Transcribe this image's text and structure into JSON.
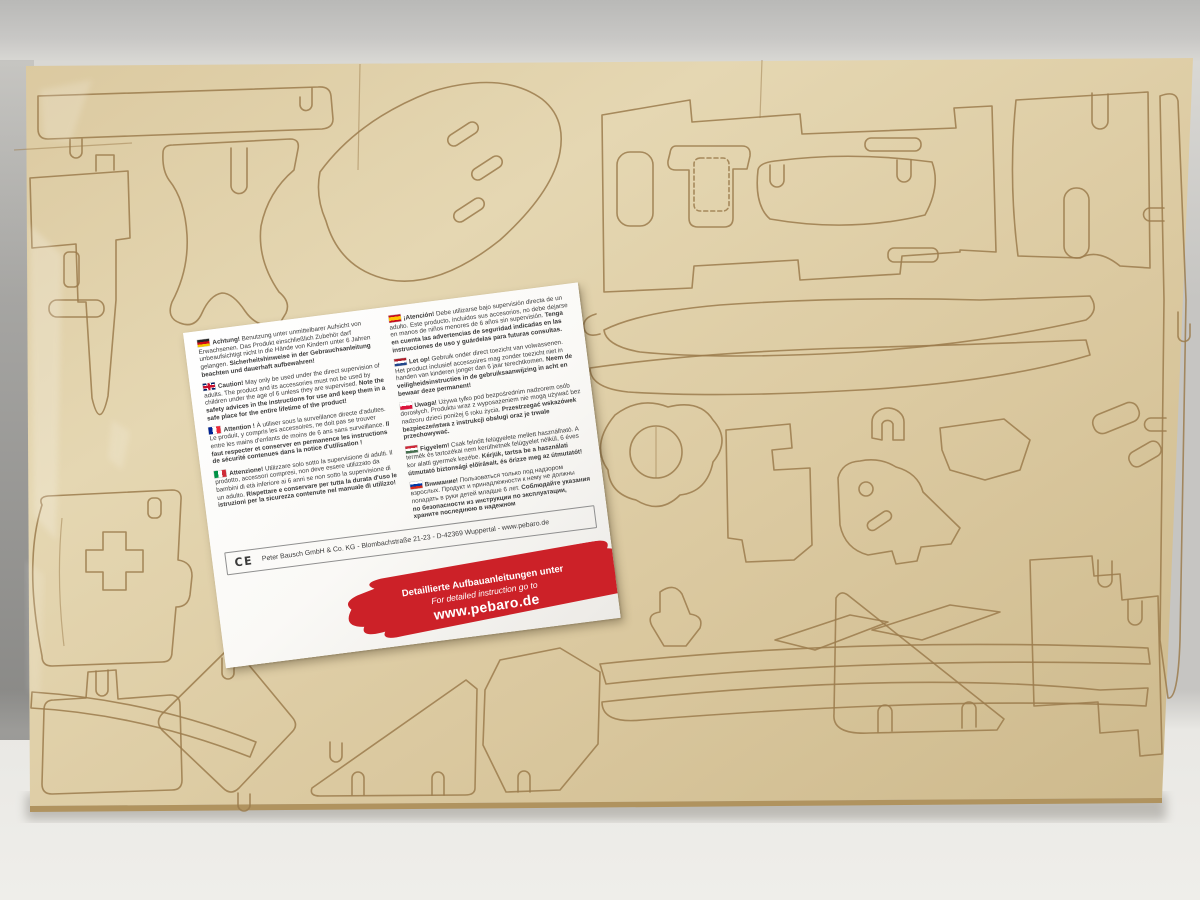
{
  "colors": {
    "wall-top": "#b9b9b7",
    "wall-mid": "#c8c7c5",
    "wall-light": "#d9d8d4",
    "wall-side": "#c6c5c2",
    "table": "#e9e8e4",
    "table-bright": "#efeeea",
    "wood-light": "#e5d7b2",
    "wood-base": "#dbc9a0",
    "wood-dark": "#cdb98c",
    "cut-line": "#9b7b4c",
    "board-edge": "#b0935f",
    "label-bg": "#faf9f6",
    "label-text": "#3b3b3b",
    "banner-red": "#cc2128",
    "banner-text": "#ffffff"
  },
  "label": {
    "sections": [
      {
        "flag": "de",
        "lead": "Achtung!",
        "body": "Benutzung unter unmittelbarer Aufsicht von Erwachsenen. Das Produkt einschließlich Zubehör darf unbeaufsichtigt nicht in die Hände von Kindern unter 6 Jahren gelangen.",
        "bold": "Sicherheitshinweise in der Gebrauchsanleitung beachten und dauerhaft aufbewahren!"
      },
      {
        "flag": "gb",
        "lead": "Caution!",
        "body": "May only be used under the direct supervision of adults. The product and its accessories must not be used by children under the age of 6 unless they are supervised.",
        "bold": "Note the safety advices in the instructions for use and keep them in a safe place for the entire lifetime of the product!"
      },
      {
        "flag": "fr",
        "lead": "Attention !",
        "body": "À utiliser sous la surveillance directe d'adultes. Le produit, y compris les accessoires, ne doit pas se trouver entre les mains d'enfants de moins de 6 ans sans surveillance.",
        "bold": "Il faut respecter et conserver en permanence les instructions de sécurité contenues dans la notice d'utilisation !"
      },
      {
        "flag": "it",
        "lead": "Attenzione!",
        "body": "Utilizzare solo sotto la supervisione di adulti. Il prodotto, accessori compresi, non deve essere utilizzato da bambini di età inferiore ai 6 anni se non sotto la supervisione di un adulto.",
        "bold": "Rispettare e conservare per tutta la durata d'uso le istruzioni per la sicurezza contenute nel manuale di utilizzo!"
      },
      {
        "flag": "es",
        "lead": "¡Atención!",
        "body": "Debe utilizarse bajo supervisión directa de un adulto. Este producto, incluidos sus accesorios, no debe dejarse en manos de niños menores de 6 años sin supervisión.",
        "bold": "Tenga en cuenta las advertencias de seguridad indicadas en las instrucciones de uso y guárdelas para futuras consultas."
      },
      {
        "flag": "nl",
        "lead": "Let op!",
        "body": "Gebruik onder direct toezicht van volwassenen. Het product inclusief accessoires mag zonder toezicht niet in handen van kinderen jonger dan 6 jaar terechtkomen.",
        "bold": "Neem de veiligheidsinstructies in de gebruiksaanwijzing in acht en bewaar deze permanent!"
      },
      {
        "flag": "pl",
        "lead": "Uwaga!",
        "body": "Używa tylko pod bezpośrednim nadzorem osób dorosłych. Produktu wraz z wyposażeniem nie mogą używać bez nadzoru dzieci poniżej 6 roku życia.",
        "bold": "Przestrzegać wskazówek bezpieczeństwa z instrukcji obsługi oraz je trwale przechowywać."
      },
      {
        "flag": "hu",
        "lead": "Figyelem!",
        "body": "Csak felnőtt felügyelete mellett használható. A termék és tartozékai nem kerülhetnek felügyelet nélkül, 6 éves kor alatti gyermek kezébe.",
        "bold": "Kérjük, tartsa be a használati útmutató biztonsági előírásait, és őrizze meg az útmutatót!"
      },
      {
        "flag": "ru",
        "lead": "Внимание!",
        "body": "Пользоваться только под надзором взрослых. Продукт и принадлежности к нему не должны попадать в руки детей младше 6 лет.",
        "bold": "Соблюдайте указания по безопасности из инструкции по эксплуатации, храните последнюю в надежном"
      }
    ],
    "footer": {
      "ce_mark": "CE",
      "address": "Peter Bausch GmbH & Co. KG  -  Blombachstraße 21-23  -  D-42369 Wuppertal  -  www.pebaro.de"
    },
    "banner": {
      "line1": "Detaillierte Aufbauanleitungen unter",
      "line2": "For detailed instruction go to",
      "line3": "www.pebaro.de"
    }
  }
}
